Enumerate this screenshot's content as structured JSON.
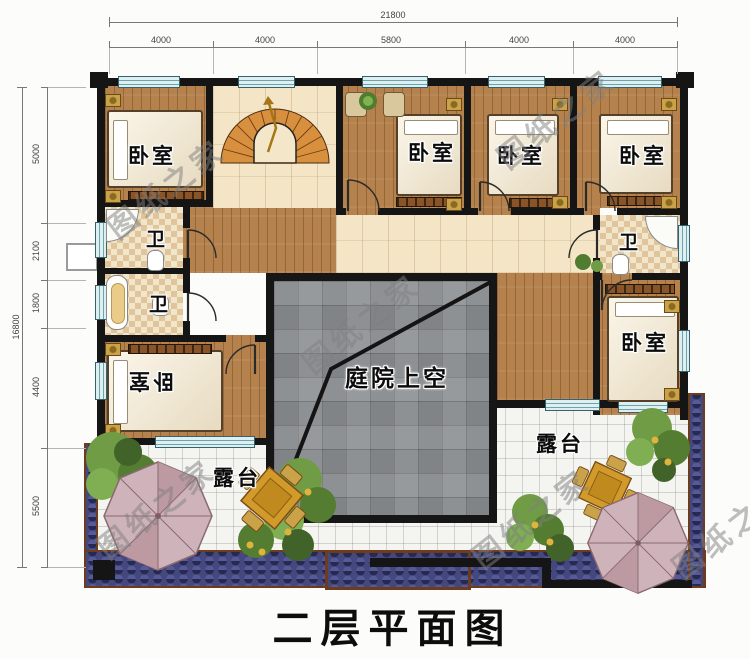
{
  "title": "二层平面图",
  "watermark_text": "图纸之家",
  "dimensions": {
    "top": {
      "total": "21800",
      "segments": [
        "4000",
        "4000",
        "5800",
        "4000",
        "4000"
      ]
    },
    "left": {
      "total": "16800",
      "segments": [
        "5000",
        "2100",
        "1800",
        "4400",
        "5500"
      ]
    }
  },
  "rooms": {
    "bedroom_top_left": "卧室",
    "bedroom_top_mid": "卧室",
    "bedroom_top_right_inner": "卧室",
    "bedroom_top_right": "卧室",
    "bedroom_bottom_left": "卧室",
    "bedroom_right": "卧室",
    "bath_left_upper": "卫",
    "bath_left_lower": "卫",
    "bath_right": "卫",
    "courtyard": "庭院上空",
    "terrace_left": "露台",
    "terrace_right": "露台"
  }
}
